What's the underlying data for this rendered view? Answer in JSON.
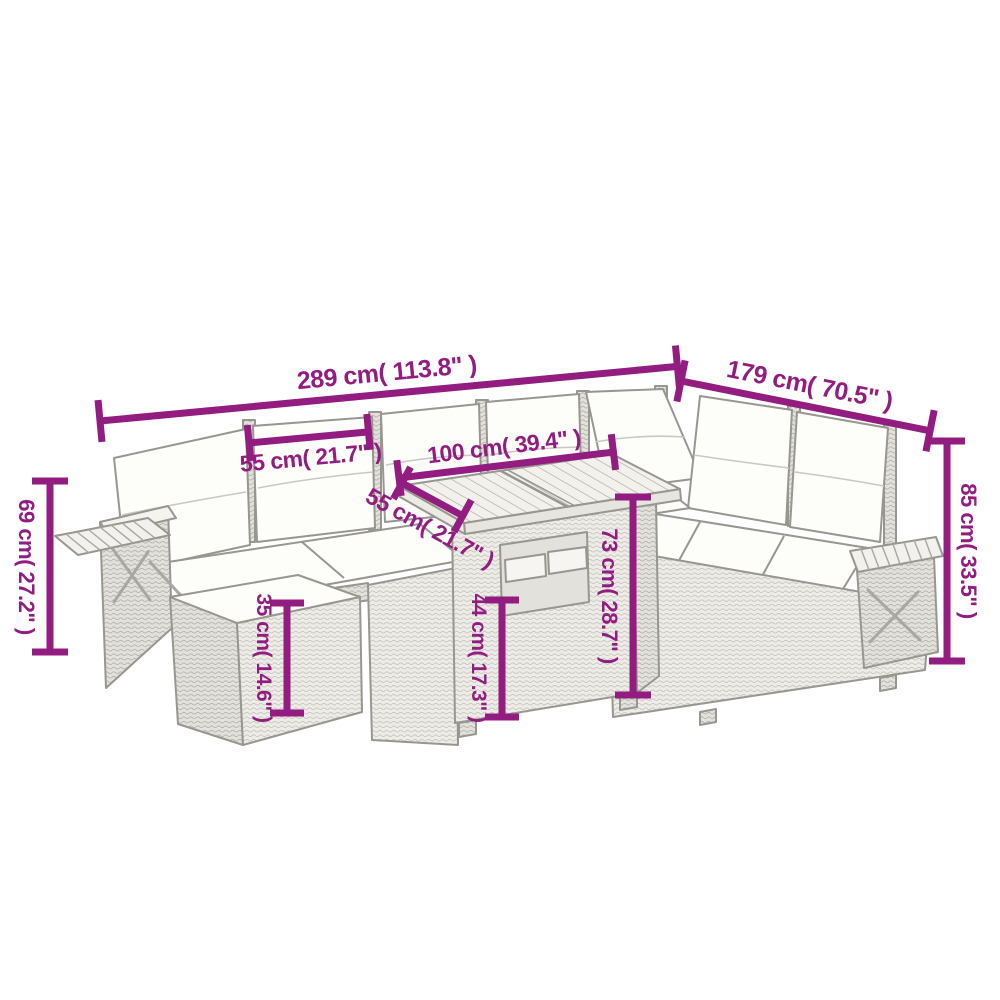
{
  "figure": {
    "type": "product-dimension-diagram",
    "subject": "L-shaped rattan garden sofa set with corner sofa, ottoman, tray-shelf armrests and slatted-top table (gray line drawing)",
    "background_color": "#ffffff",
    "line_art_color": "#97968f",
    "dimension_color": "#921c80"
  },
  "labels": {
    "total_width": "289 cm( 113.8\" )",
    "total_depth": "179 cm( 70.5\" )",
    "seat_width": "55 cm( 21.7\" )",
    "table_top_width": "100 cm( 39.4\" )",
    "table_top_depth": "55 cm( 21.7\" )",
    "arm_height": "69 cm( 27.2\" )",
    "back_height": "85 cm( 33.5\" )",
    "table_height": "73 cm( 28.7\" )",
    "table_base_height": "44 cm( 17.3\" )",
    "ottoman_height": "35 cm( 14.6\" )"
  }
}
